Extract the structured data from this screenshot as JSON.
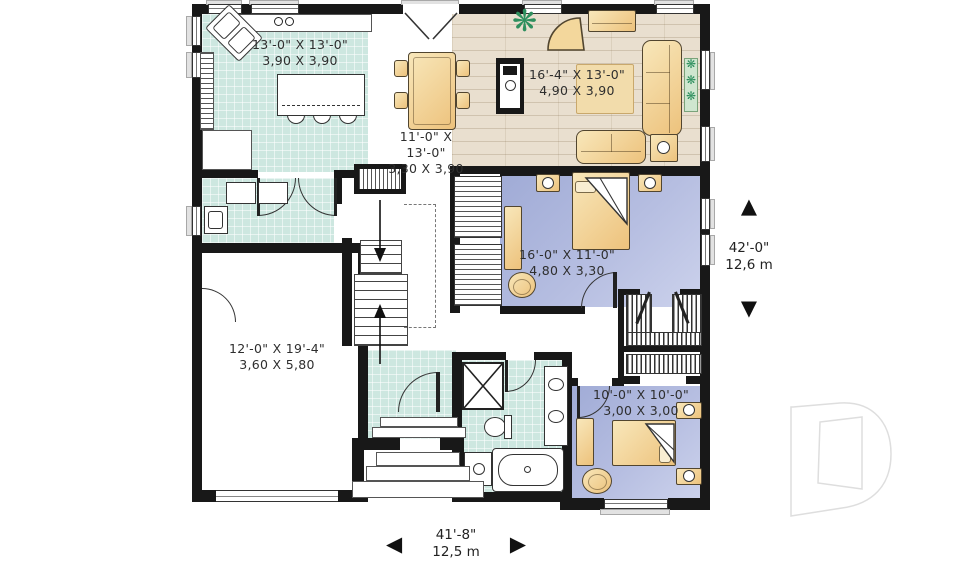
{
  "watermark": "D",
  "icons": {
    "arrow_up": "▲",
    "arrow_down": "▼",
    "arrow_left": "◀",
    "arrow_right": "▶",
    "plant": "❋"
  },
  "rooms": [
    {
      "name": "kitchen",
      "imperial": "13'-0\" X 13'-0\"",
      "metric": "3,90 X 3,90"
    },
    {
      "name": "dining",
      "imperial": "11'-0\" X 13'-0\"",
      "metric": "3,30 X 3,90"
    },
    {
      "name": "living",
      "imperial": "16'-4\" X 13'-0\"",
      "metric": "4,90 X 3,90"
    },
    {
      "name": "master-bedroom",
      "imperial": "16'-0\" X 11'-0\"",
      "metric": "4,80 X 3,30"
    },
    {
      "name": "garage",
      "imperial": "12'-0\" X 19'-4\"",
      "metric": "3,60 X 5,80"
    },
    {
      "name": "bedroom-2",
      "imperial": "10'-0\" X 10'-0\"",
      "metric": "3,00 X 3,00"
    }
  ],
  "overall_dimensions": {
    "depth": {
      "imperial": "42'-0\"",
      "metric": "12,6 m"
    },
    "width": {
      "imperial": "41'-8\"",
      "metric": "12,5 m"
    }
  },
  "colors": {
    "tile": "#cde7e0",
    "wood": "#e9dfcf",
    "bedroom_floor": "#aab4da",
    "furniture": "#f0cf92",
    "wall": "#181818"
  }
}
